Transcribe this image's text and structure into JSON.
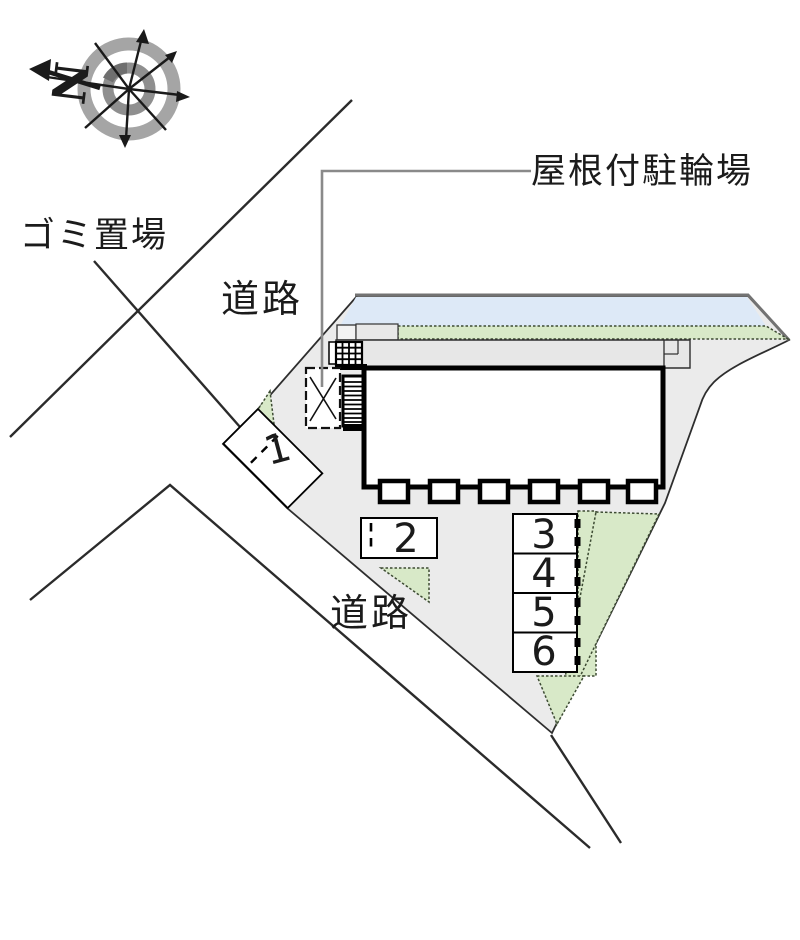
{
  "plan": {
    "compass": {
      "north_label": "N"
    },
    "labels": {
      "garbage": "ゴミ置場",
      "road_upper": "道路",
      "road_lower": "道路",
      "bicycle_parking": "屋根付駐輪場"
    },
    "parking_spaces": [
      "1",
      "2",
      "3",
      "4",
      "5",
      "6"
    ],
    "colors": {
      "site": "#ebebeb",
      "strip": "#e7e7e7",
      "roof": "#dde9f7",
      "green": "#d8e9c8",
      "leader": "#8a8a8a",
      "line": "#2b2b2b",
      "compass_ring": "#a5a5a5"
    }
  }
}
